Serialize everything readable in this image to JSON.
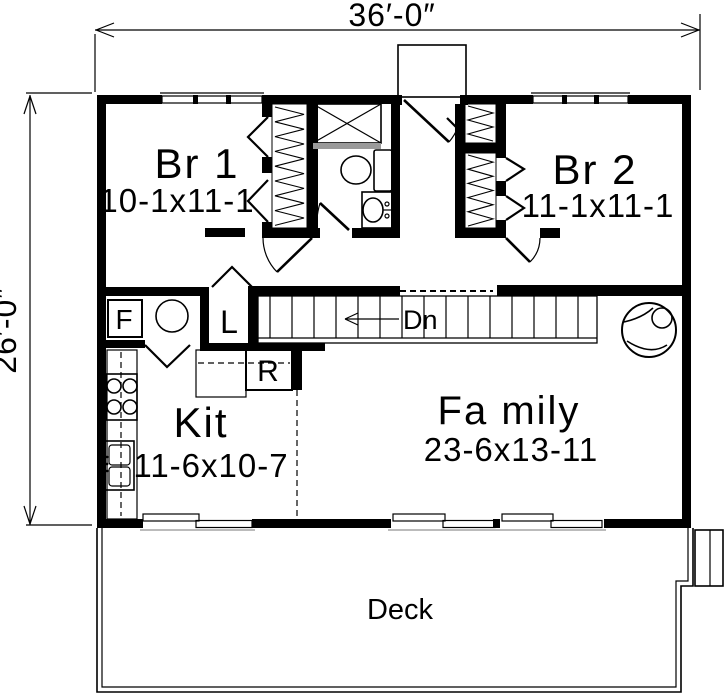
{
  "plan": {
    "title_hint": "house first floor plan",
    "dimensions": {
      "width": "36′-0″",
      "height": "26′-0″"
    },
    "rooms": [
      {
        "id": "br1",
        "name": "Br 1",
        "size": "10-1x11-1"
      },
      {
        "id": "br2",
        "name": "Br 2",
        "size": "11-1x11-1"
      },
      {
        "id": "kitchen",
        "name": "Kit",
        "size": "11-6x10-7"
      },
      {
        "id": "family",
        "name": "Fa mily",
        "size": "23-6x13-11"
      },
      {
        "id": "deck",
        "name": "Deck",
        "size": ""
      }
    ],
    "labels": {
      "furnace": "F",
      "linen": "L",
      "range": "R",
      "stair_direction": "Dn"
    },
    "colors": {
      "line": "#000000",
      "background": "#ffffff"
    }
  }
}
